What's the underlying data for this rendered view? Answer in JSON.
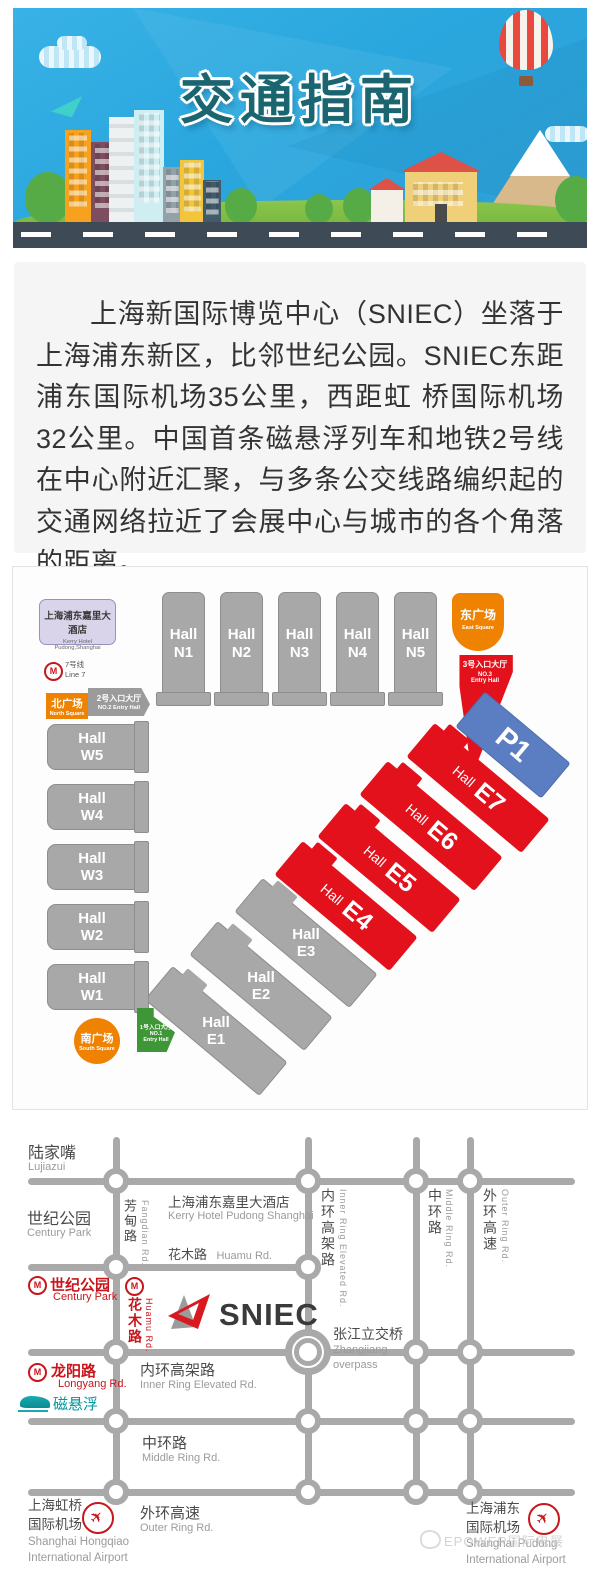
{
  "banner": {
    "title": "交通指南"
  },
  "intro": {
    "text": "上海新国际博览中心（SNIEC）坐落于上海浦东新区，比邻世纪公园。SNIEC东距浦东国际机场35公里，西距虹 桥国际机场32公里。中国首条磁悬浮列车和地铁2号线在中心附近汇聚，与多条公交线路编织起的交通网络拉近了会展中心与城市的各个角落的距离。"
  },
  "venue": {
    "hall_word": "Hall",
    "kerry": {
      "cn": "上海浦东嘉里大酒店",
      "en": "Kerry Hotel Pudong,Shanghai"
    },
    "line7": {
      "cn": "7号线",
      "en": "Line 7"
    },
    "north_square": {
      "cn": "北广场",
      "en": "North Square"
    },
    "entry2": {
      "cn": "2号入口大厅",
      "en": "NO.2 Entry Hall"
    },
    "east_square": {
      "cn": "东广场",
      "en": "East Square"
    },
    "entry3": {
      "cn": "3号入口大厅",
      "en1": "NO.3",
      "en2": "Entry Hall"
    },
    "entry1": {
      "cn": "1号入口大厅",
      "en1": "NO.1",
      "en2": "Entry Hall"
    },
    "south_square": {
      "cn": "南广场",
      "en": "South Square"
    },
    "p1": "P1",
    "n": [
      "N1",
      "N2",
      "N3",
      "N4",
      "N5"
    ],
    "w": [
      "W5",
      "W4",
      "W3",
      "W2",
      "W1"
    ],
    "e_red": [
      "E7",
      "E6",
      "E5",
      "E4"
    ],
    "e_gray": [
      "E3",
      "E2",
      "E1"
    ]
  },
  "road": {
    "lujiazui": {
      "cn": "陆家嘴",
      "en": "Lujiazui"
    },
    "century_park": {
      "cn": "世纪公园",
      "en": "Century Park"
    },
    "kerry": {
      "cn": "上海浦东嘉里大酒店",
      "en": "Kerry Hotel Pudong Shanghai"
    },
    "fangdian": {
      "cn": "芳甸路",
      "en": "Fangdian Rd."
    },
    "huamu": {
      "cn": "花木路",
      "en": "Huamu Rd."
    },
    "st_century": {
      "cn": "世纪公园",
      "en": "Century Park"
    },
    "st_huamu": {
      "cn": "花木路",
      "en": "Huamu Rd."
    },
    "sniec": "SNIEC",
    "inner_ring": {
      "cn": "内环高架路",
      "en": "Inner Ring Elevated Rd."
    },
    "middle_ring": {
      "cn": "中环路",
      "en": "Middle Ring Rd."
    },
    "outer_ring": {
      "cn": "外环高速",
      "en": "Outer Ring Rd."
    },
    "zhangjiang": {
      "cn": "张江立交桥",
      "en1": "Zhangjiang",
      "en2": "overpass"
    },
    "st_longyang": {
      "cn": "龙阳路",
      "en": "Longyang Rd."
    },
    "maglev": {
      "cn": "磁悬浮"
    },
    "hongqiao": {
      "cn1": "上海虹桥",
      "cn2": "国际机场",
      "en1": "Shanghai Hongqiao",
      "en2": "International Airport"
    },
    "pudong": {
      "cn1": "上海浦东",
      "cn2": "国际机场",
      "en1": "Shanghai Pudong",
      "en2": "International Airport"
    },
    "watermark": "EPOWER国际电展"
  },
  "colors": {
    "accent_red": "#e2111c",
    "orange": "#ef8200",
    "blue_p1": "#5b7ec2",
    "green_entry": "#3f9637",
    "hall_gray": "#a8a8a8",
    "metro_red": "#c8161d",
    "maglev_teal": "#0097a0",
    "road_gray": "#a9a9a9"
  }
}
